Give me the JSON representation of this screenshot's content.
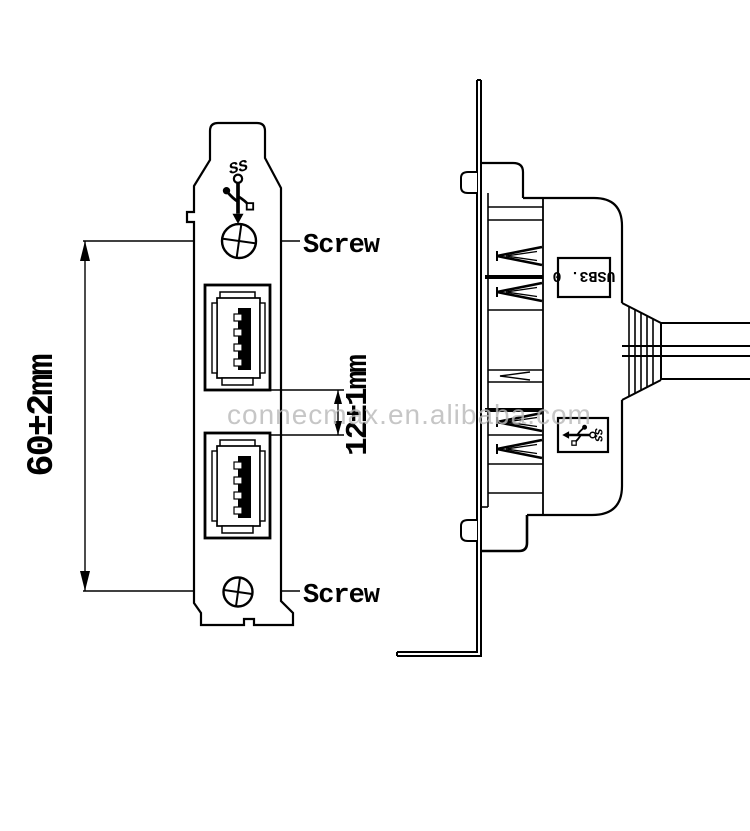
{
  "front_view": {
    "dim_height": "60±2mm",
    "dim_gap": "12±1mm",
    "screw_top_label": "Screw",
    "screw_bottom_label": "Screw",
    "ss_logo_text": "SS"
  },
  "side_view": {
    "usb_version_label": "USB3. 0",
    "ss_logo_text": "SS"
  },
  "watermark": "connecmax.en.alibaba.com",
  "colors": {
    "line": "#000000",
    "background": "#ffffff",
    "watermark": "#b9b9b9"
  },
  "icons": {
    "front_panel_logo": "usb-superspeed-trident-icon",
    "side_panel_logo": "usb-superspeed-trident-icon",
    "screws": "phillips-screw-icon"
  }
}
